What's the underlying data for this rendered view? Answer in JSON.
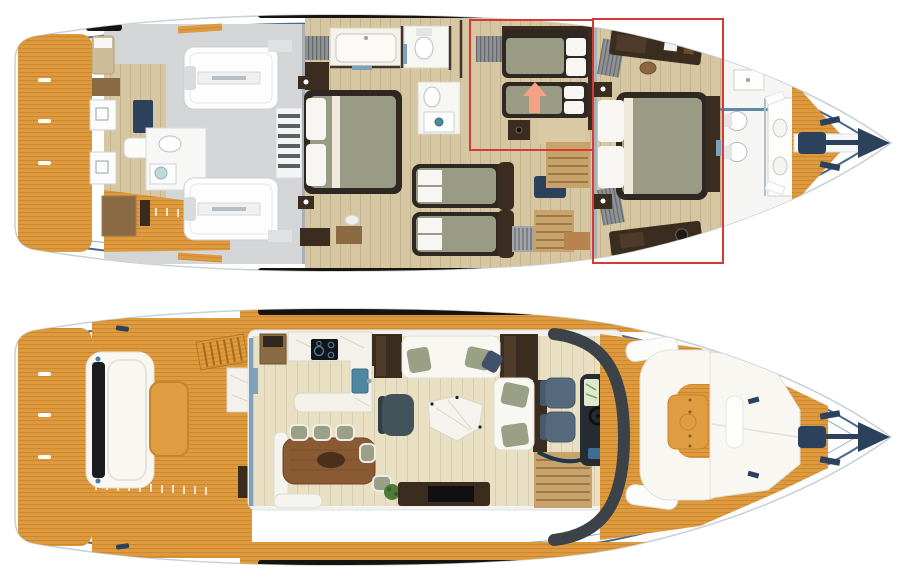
{
  "scene": {
    "type": "yacht-floor-plan",
    "deck_views": 2
  },
  "colors": {
    "teak": "#DE9A3F",
    "teak_line": "#C17A1E",
    "teak_table": "#DF9C41",
    "hull_white": "#FFFFFF",
    "hull_edge": "#C7D0D6",
    "trim": "#47698C",
    "trim_light": "#93ACBF",
    "gray_floor": "#D3D5D6",
    "wood_floor": "#D6C7A2",
    "wood_floor_light": "#E9DFC2",
    "dark_wood": "#3A2C1F",
    "mid_wood": "#8A6A42",
    "wall": "#41342A",
    "bed_frame": "#2F2721",
    "mattress": "#9A9B85",
    "pillow": "#F7F6F2",
    "bench_gray": "#8F9294",
    "navy": "#2C415C",
    "steel_door": "#7FA0BD",
    "marble": "#F3F1EA",
    "marble_vein": "#D8D5CB",
    "cooktop": "#131519",
    "sink": "#4E87A0",
    "sofa": "#F8F7F2",
    "sofa_edge": "#E1E1D8",
    "cushion_green": "#99A086",
    "cushion_navy": "#41506B",
    "armchair": "#425459",
    "helm_seat": "#56697C",
    "console": "#262C31",
    "lime": "#A6C544",
    "chart": "#DFE8CF",
    "stair_wood": "#C8A26B",
    "stair_tread": "#9A7848",
    "window": "#17140F",
    "red": "#D63A36",
    "arrow": "#F4A286",
    "plant": "#4F7D38",
    "radiator": "#A3A6A8",
    "table_wood": "#8A5A33"
  },
  "annotations": {
    "highlight_boxes": [
      {
        "name": "twin-cabin-highlight",
        "x": 470,
        "y": 20,
        "width": 123,
        "height": 130
      },
      {
        "name": "master-cabin-highlight",
        "x": 593,
        "y": 19,
        "width": 130,
        "height": 244
      }
    ],
    "arrow": {
      "direction": "up"
    }
  }
}
